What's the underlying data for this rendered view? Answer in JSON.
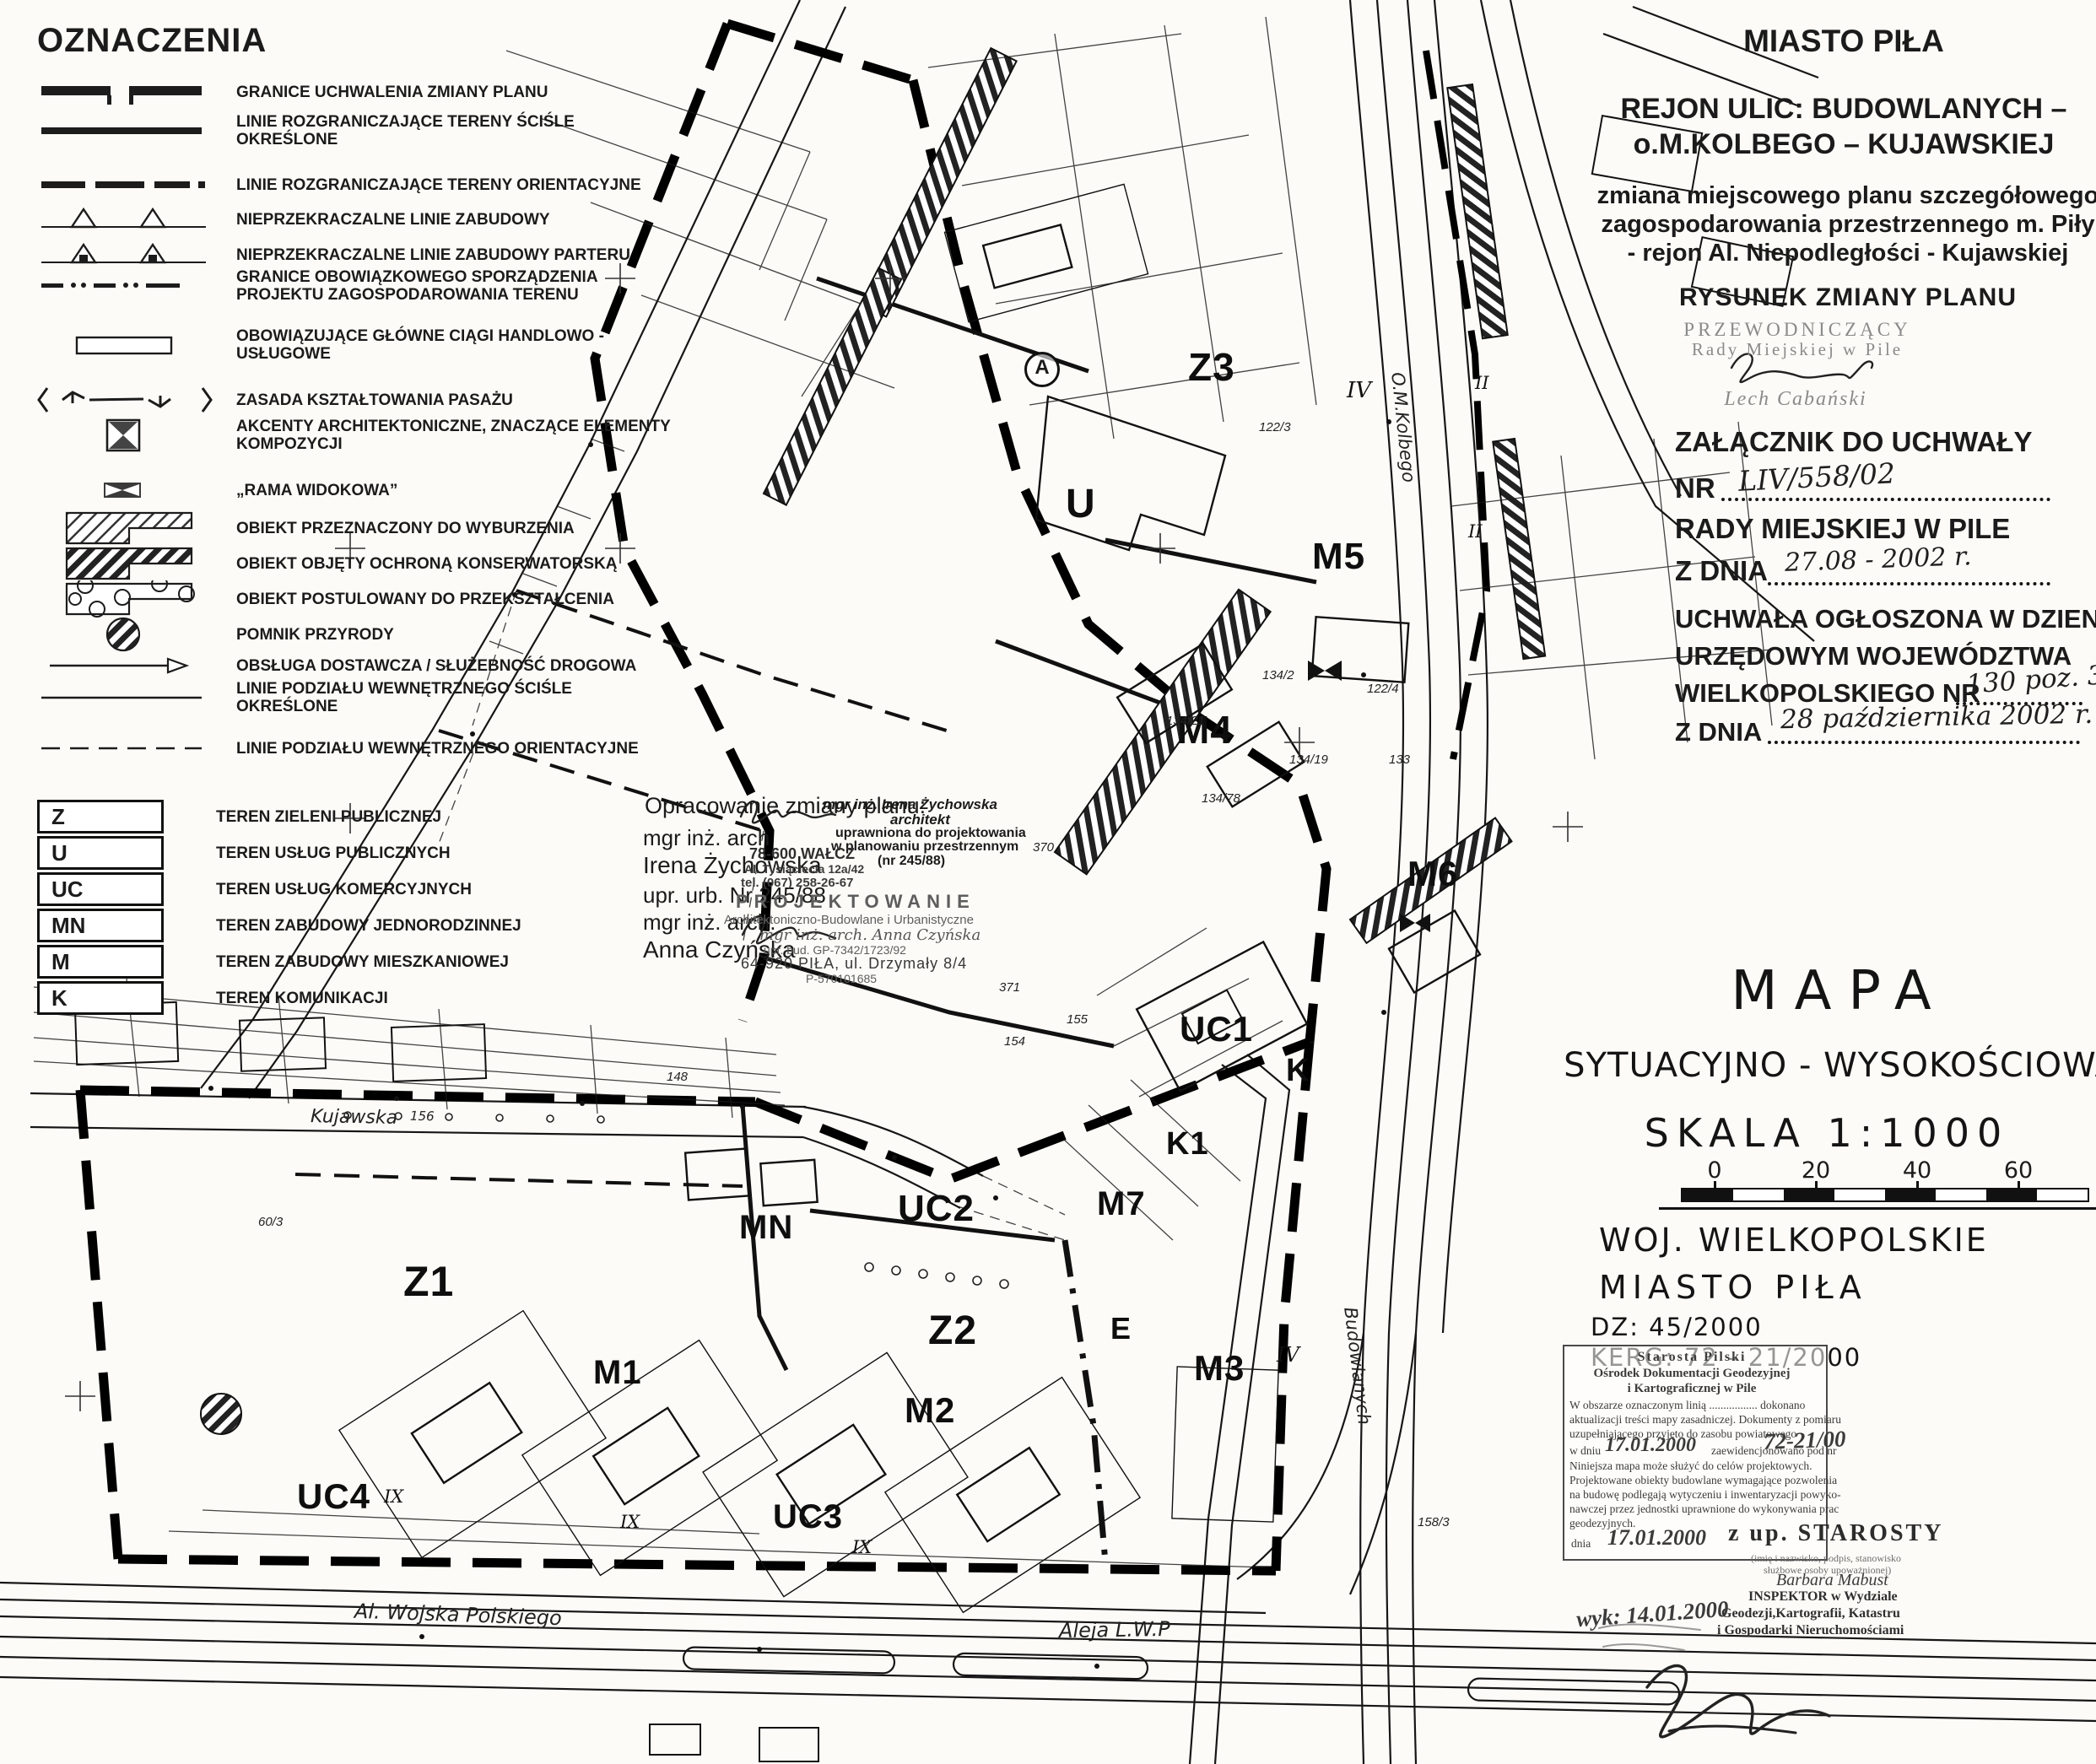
{
  "legend": {
    "title": "OZNACZENIA",
    "items": [
      {
        "label": "GRANICE UCHWALENIA ZMIANY PLANU"
      },
      {
        "label": "LINIE ROZGRANICZAJĄCE TERENY ŚCIŚLE OKREŚLONE"
      },
      {
        "label": "LINIE ROZGRANICZAJĄCE TERENY ORIENTACYJNE"
      },
      {
        "label": "NIEPRZEKRACZALNE LINIE ZABUDOWY"
      },
      {
        "label": "NIEPRZEKRACZALNE LINIE ZABUDOWY PARTERU"
      },
      {
        "label": "GRANICE OBOWIĄZKOWEGO SPORZĄDZENIA PROJEKTU ZAGOSPODAROWANIA TERENU"
      },
      {
        "label": "OBOWIĄZUJĄCE GŁÓWNE CIĄGI HANDLOWO - USŁUGOWE"
      },
      {
        "label": "ZASADA KSZTAŁTOWANIA  PASAŻU"
      },
      {
        "label": "AKCENTY ARCHITEKTONICZNE, ZNACZĄCE ELEMENTY KOMPOZYCJI"
      },
      {
        "label": "„RAMA WIDOKOWA”"
      },
      {
        "label": "OBIEKT PRZEZNACZONY DO WYBURZENIA"
      },
      {
        "label": "OBIEKT OBJĘTY OCHRONĄ KONSERWATORSKĄ"
      },
      {
        "label": "OBIEKT POSTULOWANY DO PRZEKSZTAŁCENIA"
      },
      {
        "label": "POMNIK PRZYRODY"
      },
      {
        "label": "OBSŁUGA DOSTAWCZA / SŁUŻEBNOŚĆ DROGOWA"
      },
      {
        "label": "LINIE PODZIAŁU WEWNĘTRZNEGO ŚCIŚLE OKREŚLONE"
      },
      {
        "label": "LINIE PODZIAŁU WEWNĘTRZNEGO ORIENTACYJNE"
      }
    ],
    "zones": [
      {
        "code": "Z",
        "label": "TEREN ZIELENI PUBLICZNEJ"
      },
      {
        "code": "U",
        "label": "TEREN USŁUG PUBLICZNYCH"
      },
      {
        "code": "UC",
        "label": "TEREN USŁUG KOMERCYJNYCH"
      },
      {
        "code": "MN",
        "label": "TEREN ZABUDOWY JEDNORODZINNEJ"
      },
      {
        "code": "M",
        "label": "TEREN ZABUDOWY MIESZKANIOWEJ"
      },
      {
        "code": "K",
        "label": "TEREN KOMUNIKACJI"
      }
    ]
  },
  "header": {
    "city": "MIASTO PIŁA",
    "region_line1": "REJON ULIC: BUDOWLANYCH –",
    "region_line2": "o.M.KOLBEGO – KUJAWSKIEJ",
    "subtitle_line1": "zmiana miejscowego planu szczegółowego",
    "subtitle_line2": "zagospodarowania przestrzennego m. Piły",
    "subtitle_line3": "- rejon Al. Niepodległości - Kujawskiej",
    "drawing_title": "RYSUNEK ZMIANY PLANU"
  },
  "chairman": {
    "role_line1": "PRZEWODNICZĄCY",
    "role_line2": "Rady Miejskiej w Pile",
    "name": "Lech Cabański"
  },
  "attachment": {
    "line1": "ZAŁĄCZNIK DO UCHWAŁY",
    "nr_label": "NR",
    "nr_value": "LIV/558/02",
    "line2": "RADY MIEJSKIEJ W PILE",
    "date_label": "Z DNIA",
    "date_value": "27.08 - 2002 r."
  },
  "announcement": {
    "line1": "UCHWAŁA  OGŁOSZONA W DZIENNIKU",
    "line2": "URZĘDOWYM WOJEWÓDZTWA",
    "line3_label": "WIELKOPOLSKIEGO NR",
    "line3_value": "130 poz. 3576",
    "date_label": "Z DNIA",
    "date_value": "28 października 2002 r."
  },
  "map_title": {
    "line1": "MAPA",
    "line2": "SYTUACYJNO - WYSOKOŚCIOWA",
    "scale": "SKALA  1:1000",
    "scale_ticks": [
      "0",
      "20",
      "40",
      "60"
    ],
    "province": "WOJ. WIELKOPOLSKIE",
    "city": "MIASTO  PIŁA",
    "dz": "DZ: 45/2000",
    "kerg": "KERG: 72 - 21/2000"
  },
  "author_note": {
    "heading": "Opracowanie zmiany planu:",
    "line1": "mgr inż. arch",
    "line2": "Irena Żychowska",
    "line3": "upr. urb. Nr 245/88",
    "line4": "mgr inż. arch.",
    "line5": "Anna Czyńska",
    "stamp1_line1": "mgr inż. Irena Żychowska",
    "stamp1_line2": "architekt",
    "stamp1_line3": "uprawniona do projektowania",
    "stamp1_line4": "w planowaniu przestrzennym",
    "stamp1_line5": "(nr 245/88)",
    "stamp2_line1": "78-600 WAŁCZ",
    "stamp2_line2": "Al. Tysiąclecia 12a/42",
    "stamp2_line3": "tel. (067) 258-26-67",
    "stamp3_line1": "PROJEKTOWANIE",
    "stamp3_line2": "Architektoniczno-Budowlane i Urbanistyczne",
    "stamp3_line3": "mgr inż. arch. Anna Czyńska",
    "stamp3_line4": "upr. bud. GP-7342/1723/92",
    "stamp3_line5": "64-920 PIŁA, ul. Drzymały 8/4",
    "stamp3_line6": "P-570101685"
  },
  "stamp": {
    "title1": "Starosta Pilski",
    "title2": "Ośrodek Dokumentacji Geodezyjnej",
    "title3": "i Kartograficznej w Pile",
    "body1": "W obszarze oznaczonym linią ................. dokonano",
    "body2": "aktualizacji treści mapy zasadniczej. Dokumenty z pomiaru",
    "body3": "uzupełniającego przyjęto do zasobu powiatowego",
    "body4a": "w dniu",
    "body4_date": "17.01.2000",
    "body4b": "zaewidencjonowano pod nr",
    "body4_nr": "72-21/00",
    "body5": "Niniejsza mapa może służyć do celów projektowych.",
    "body6": "Projektowane obiekty budowlane wymagające pozwolenia",
    "body7": "na budowę podlegają wytyczeniu i inwentaryzacji powyko-",
    "body8": "nawczej przez jednostki uprawnione do wykonywania prac",
    "body9": "geodezyjnych.",
    "date_label": "dnia",
    "date_value": "17.01.2000",
    "zup": "z up. STAROSTY",
    "caption1": "(imię i nazwisko, podpis, stanowisko",
    "caption2": "służbowe osoby upoważnionej)",
    "person": "Barbara Mabust",
    "role1": "INSPEKTOR w Wydziale",
    "role2": "Geodezji,Kartografii, Katastru",
    "role3": "i Gospodarki Nieruchomościami",
    "wyk": "wyk: 14.01.2000"
  },
  "map_labels": {
    "zones": [
      {
        "text": "Z3"
      },
      {
        "text": "U"
      },
      {
        "text": "M5"
      },
      {
        "text": "M4"
      },
      {
        "text": "M6"
      },
      {
        "text": "UC1"
      },
      {
        "text": "K"
      },
      {
        "text": "K1"
      },
      {
        "text": "M7"
      },
      {
        "text": "UC2"
      },
      {
        "text": "MN"
      },
      {
        "text": "Z1"
      },
      {
        "text": "Z2"
      },
      {
        "text": "E"
      },
      {
        "text": "M1"
      },
      {
        "text": "M2"
      },
      {
        "text": "M3"
      },
      {
        "text": "UC3"
      },
      {
        "text": "UC4"
      }
    ],
    "streets": [
      {
        "text": "Kujawska"
      },
      {
        "text": "156"
      },
      {
        "text": "Al. Wojska Polskiego"
      },
      {
        "text": "Aleja L.W.P"
      },
      {
        "text": "O.M.Kolbego"
      },
      {
        "text": "Budowlanych"
      }
    ],
    "numerals": [
      {
        "text": "IV"
      },
      {
        "text": "IV"
      },
      {
        "text": "IX"
      },
      {
        "text": "IX"
      },
      {
        "text": "IX"
      },
      {
        "text": "II"
      },
      {
        "text": "II"
      },
      {
        "text": "A"
      }
    ],
    "parcels": [
      {
        "text": "122/3"
      },
      {
        "text": "134/2"
      },
      {
        "text": "134/21"
      },
      {
        "text": "134/19"
      },
      {
        "text": "134/78"
      },
      {
        "text": "122/4"
      },
      {
        "text": "133"
      },
      {
        "text": "370"
      },
      {
        "text": "371"
      },
      {
        "text": "155"
      },
      {
        "text": "154"
      },
      {
        "text": "148"
      },
      {
        "text": "60/3"
      },
      {
        "text": "158/3"
      }
    ]
  },
  "colors": {
    "ink": "#111111",
    "paper": "#fcfbf7",
    "stamp_gray": "#8a8a8a"
  }
}
